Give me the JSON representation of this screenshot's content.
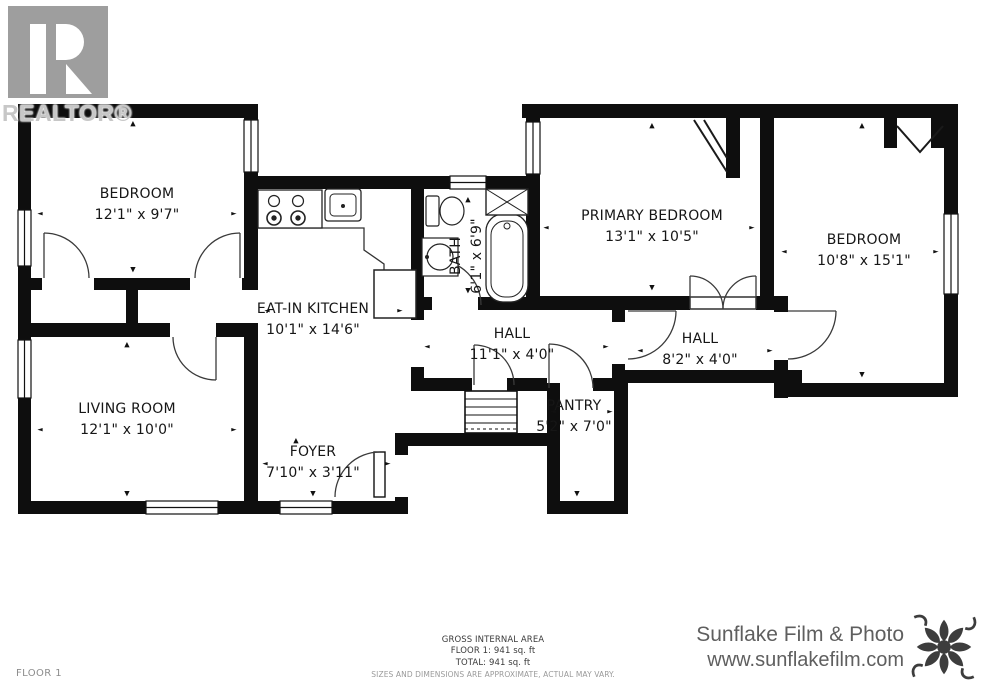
{
  "branding": {
    "realtor_wordmark": "REALTOR®"
  },
  "rooms": [
    {
      "id": "bedroom-1",
      "name": "BEDROOM",
      "dims": "12'1\" x 9'7\""
    },
    {
      "id": "eat-in-kitchen",
      "name": "EAT-IN KITCHEN",
      "dims": "10'1\" x 14'6\""
    },
    {
      "id": "bath",
      "name": "BATH",
      "dims": "6'1\" x 6'9\""
    },
    {
      "id": "primary-bedroom",
      "name": "PRIMARY BEDROOM",
      "dims": "13'1\" x 10'5\""
    },
    {
      "id": "bedroom-2",
      "name": "BEDROOM",
      "dims": "10'8\" x 15'1\""
    },
    {
      "id": "living-room",
      "name": "LIVING ROOM",
      "dims": "12'1\" x 10'0\""
    },
    {
      "id": "hall-1",
      "name": "HALL",
      "dims": "11'1\" x 4'0\""
    },
    {
      "id": "hall-2",
      "name": "HALL",
      "dims": "8'2\" x 4'0\""
    },
    {
      "id": "pantry",
      "name": "PANTRY",
      "dims": "5'2\" x 7'0\""
    },
    {
      "id": "foyer",
      "name": "FOYER",
      "dims": "7'10\" x 3'11\""
    }
  ],
  "footer": {
    "floor_label": "FLOOR 1",
    "area_title": "GROSS INTERNAL AREA",
    "area_line_floor": "FLOOR 1: 941 sq. ft",
    "area_line_total": "TOTAL: 941 sq. ft",
    "disclaimer": "SIZES AND DIMENSIONS ARE APPROXIMATE, ACTUAL MAY VARY.",
    "studio_name": "Sunflake Film & Photo",
    "studio_url": "www.sunflakefilm.com"
  },
  "colors": {
    "wall": "#0e0e0e",
    "line": "#2f2f2f",
    "logo_gray": "#9e9e9e",
    "watermark_gray": "#c7c7c7",
    "studio_text": "#5f5f5f",
    "muted_text": "#9a9a9a"
  }
}
